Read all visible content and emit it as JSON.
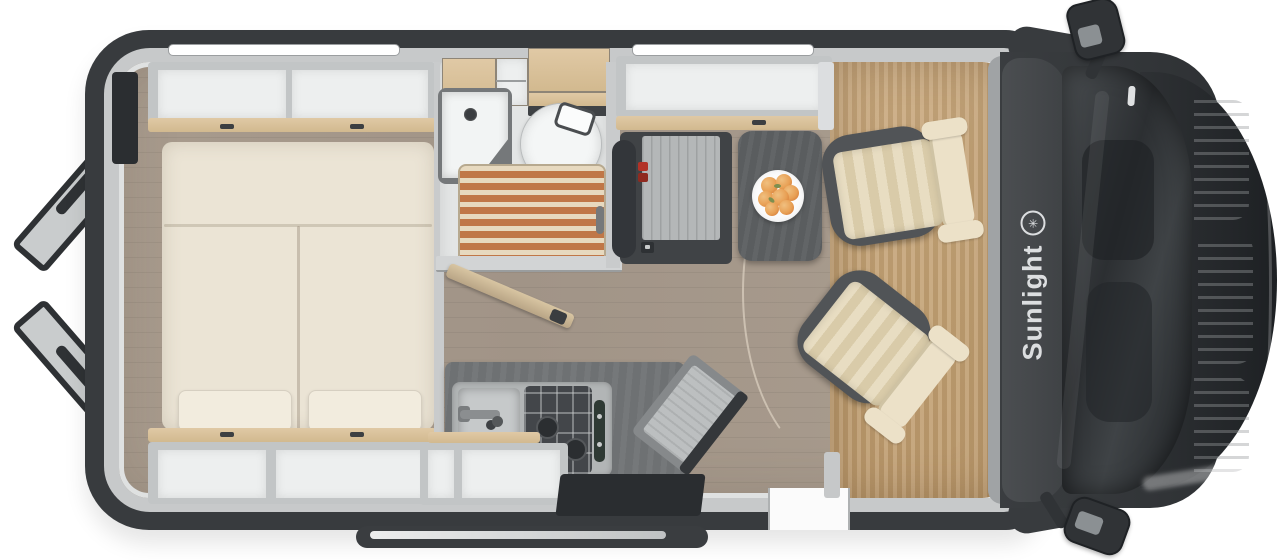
{
  "meta": {
    "title": "Camper van top-view floor plan",
    "view": "floorplan-top-down"
  },
  "branding": {
    "logo_text": "Sunlight",
    "logo_symbol": "✳",
    "logo_color": "#dcdee0"
  },
  "colors": {
    "body_dark": "#383b3e",
    "wall_gray": "#c7c9ca",
    "laminate_floor": "#a3968a",
    "cab_floor": "#c2a178",
    "mattress_cream": "#ebe4d5",
    "wood_trim": "#d7bf9b",
    "shower_teak": "#c07748",
    "table_dark": "#5a5d5f",
    "seat_beige": "#e8ddc2",
    "fridge_accent_red": "#b23227"
  },
  "features": {
    "rear_bed": "double-bed-with-two-mattresses-and-pillows",
    "storage": "open-overhead-shelves-with-wood-edges",
    "bathroom": "corner-sink-toilet-teak-shower-floor",
    "wardrobe": "fridge-wardrobe-column",
    "dinette": "pedestal-table-with-fruit-plate",
    "kitchen": "sink-and-two-burner-hob-block",
    "cab": "two-swivelled-captain-seats",
    "exterior": "rear-ladder-side-mirrors-sliding-door-rail"
  }
}
